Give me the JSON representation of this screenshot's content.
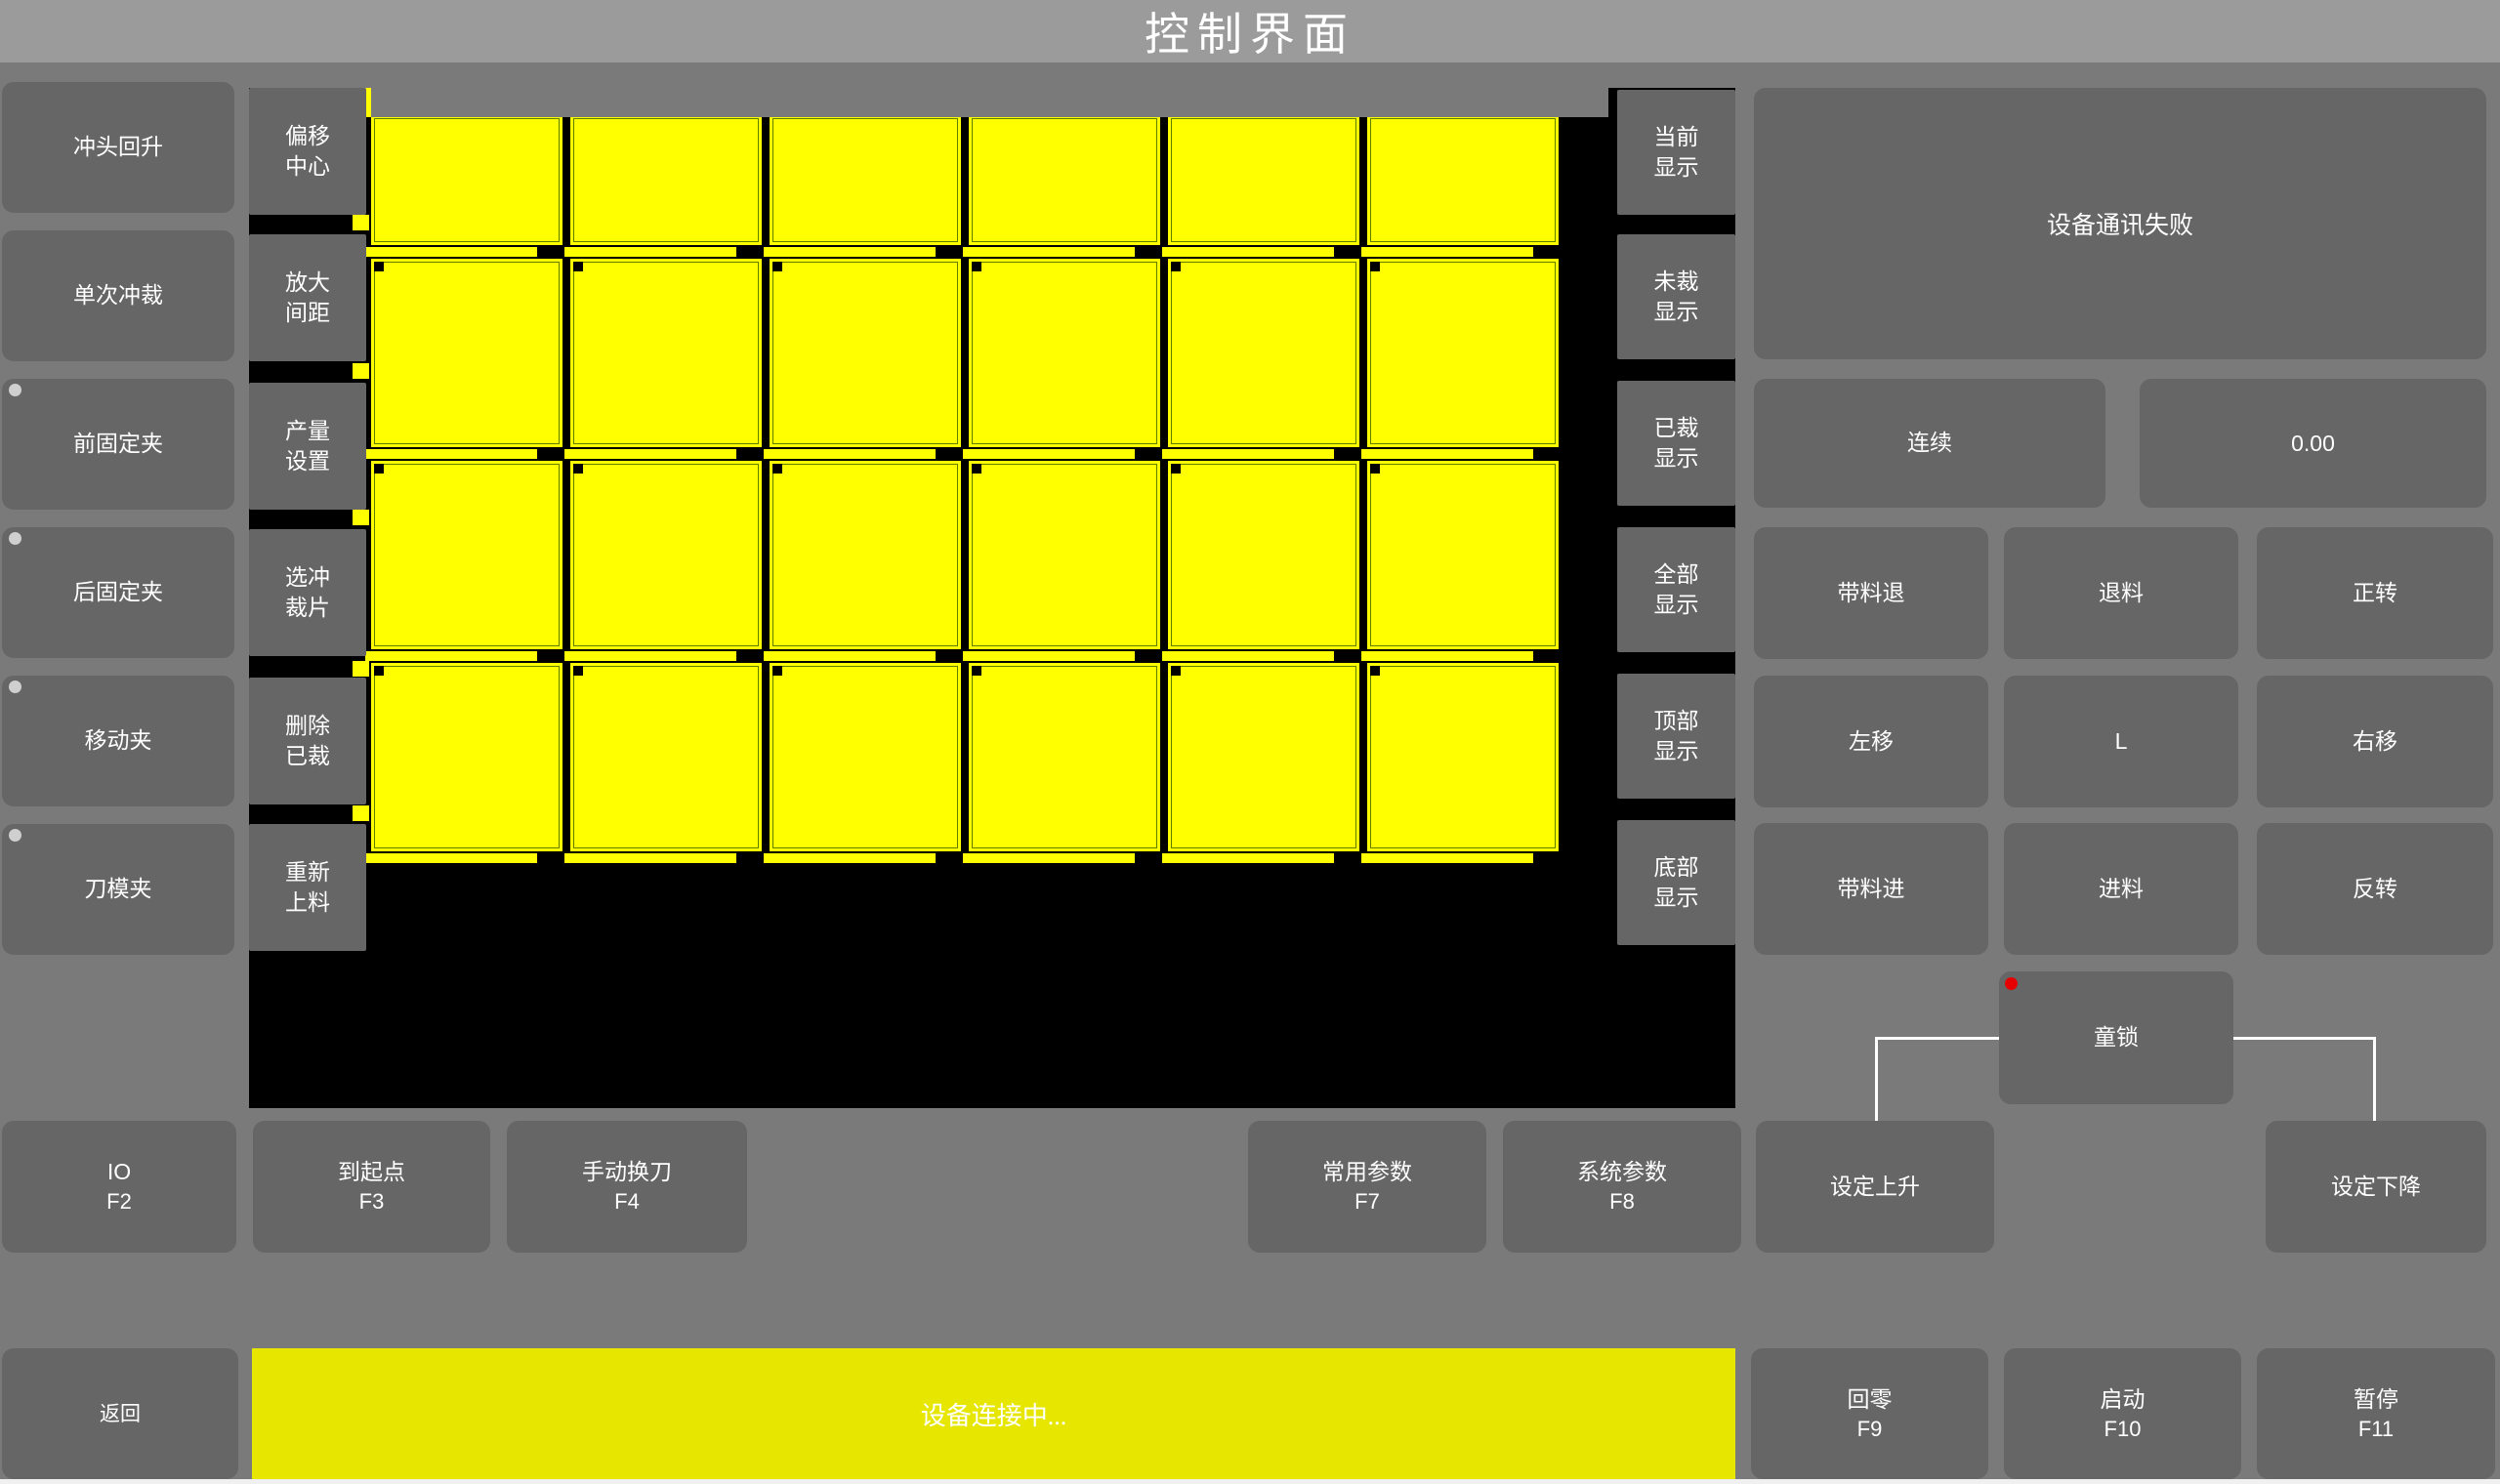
{
  "title": "控制界面",
  "left_column": {
    "buttons": [
      {
        "label": "冲头回升",
        "indicator": false
      },
      {
        "label": "单次冲裁",
        "indicator": false
      },
      {
        "label": "前固定夹",
        "indicator": true
      },
      {
        "label": "后固定夹",
        "indicator": true
      },
      {
        "label": "移动夹",
        "indicator": true
      },
      {
        "label": "刀模夹",
        "indicator": true
      }
    ]
  },
  "tool_column": {
    "buttons": [
      {
        "label": "偏移\n中心"
      },
      {
        "label": "放大\n间距"
      },
      {
        "label": "产量\n设置"
      },
      {
        "label": "选冲\n裁片"
      },
      {
        "label": "删除\n已裁"
      },
      {
        "label": "重新\n上料"
      }
    ]
  },
  "display_column": {
    "buttons": [
      {
        "label": "当前\n显示"
      },
      {
        "label": "未裁\n显示"
      },
      {
        "label": "已裁\n显示"
      },
      {
        "label": "全部\n显示"
      },
      {
        "label": "顶部\n显示"
      },
      {
        "label": "底部\n显示"
      }
    ]
  },
  "right_panel": {
    "message": "设备通讯失败",
    "mode_button": "连续",
    "value_display": "0.00",
    "jog_buttons": [
      "带料退",
      "退料",
      "正转",
      "左移",
      "L",
      "右移",
      "带料进",
      "进料",
      "反转"
    ],
    "child_lock": {
      "label": "童锁",
      "indicator_color": "#e60000"
    }
  },
  "function_row": {
    "buttons": [
      {
        "label": "IO",
        "fkey": "F2"
      },
      {
        "label": "到起点",
        "fkey": "F3"
      },
      {
        "label": "手动换刀",
        "fkey": "F4"
      },
      {
        "label": "常用参数",
        "fkey": "F7"
      },
      {
        "label": "系统参数",
        "fkey": "F8"
      },
      {
        "label": "设定上升",
        "fkey": ""
      },
      {
        "label": "设定下降",
        "fkey": ""
      }
    ]
  },
  "bottom_bar": {
    "back_button": "返回",
    "status_message": "设备连接中...",
    "home_button": {
      "label": "回零",
      "fkey": "F9"
    },
    "start_button": {
      "label": "启动",
      "fkey": "F10"
    },
    "pause_button": {
      "label": "暂停",
      "fkey": "F11"
    }
  },
  "canvas": {
    "grid": {
      "columns": 6,
      "rows": 4
    },
    "piece_color": "#ffff00",
    "background": "#000000"
  },
  "colors": {
    "background": "#7a7a7a",
    "titlebar": "#9b9b9b",
    "button": "#666666",
    "status_yellow": "#e6e600",
    "grid_yellow": "#ffff00",
    "text": "#ffffff",
    "lock_indicator_red": "#e60000"
  }
}
